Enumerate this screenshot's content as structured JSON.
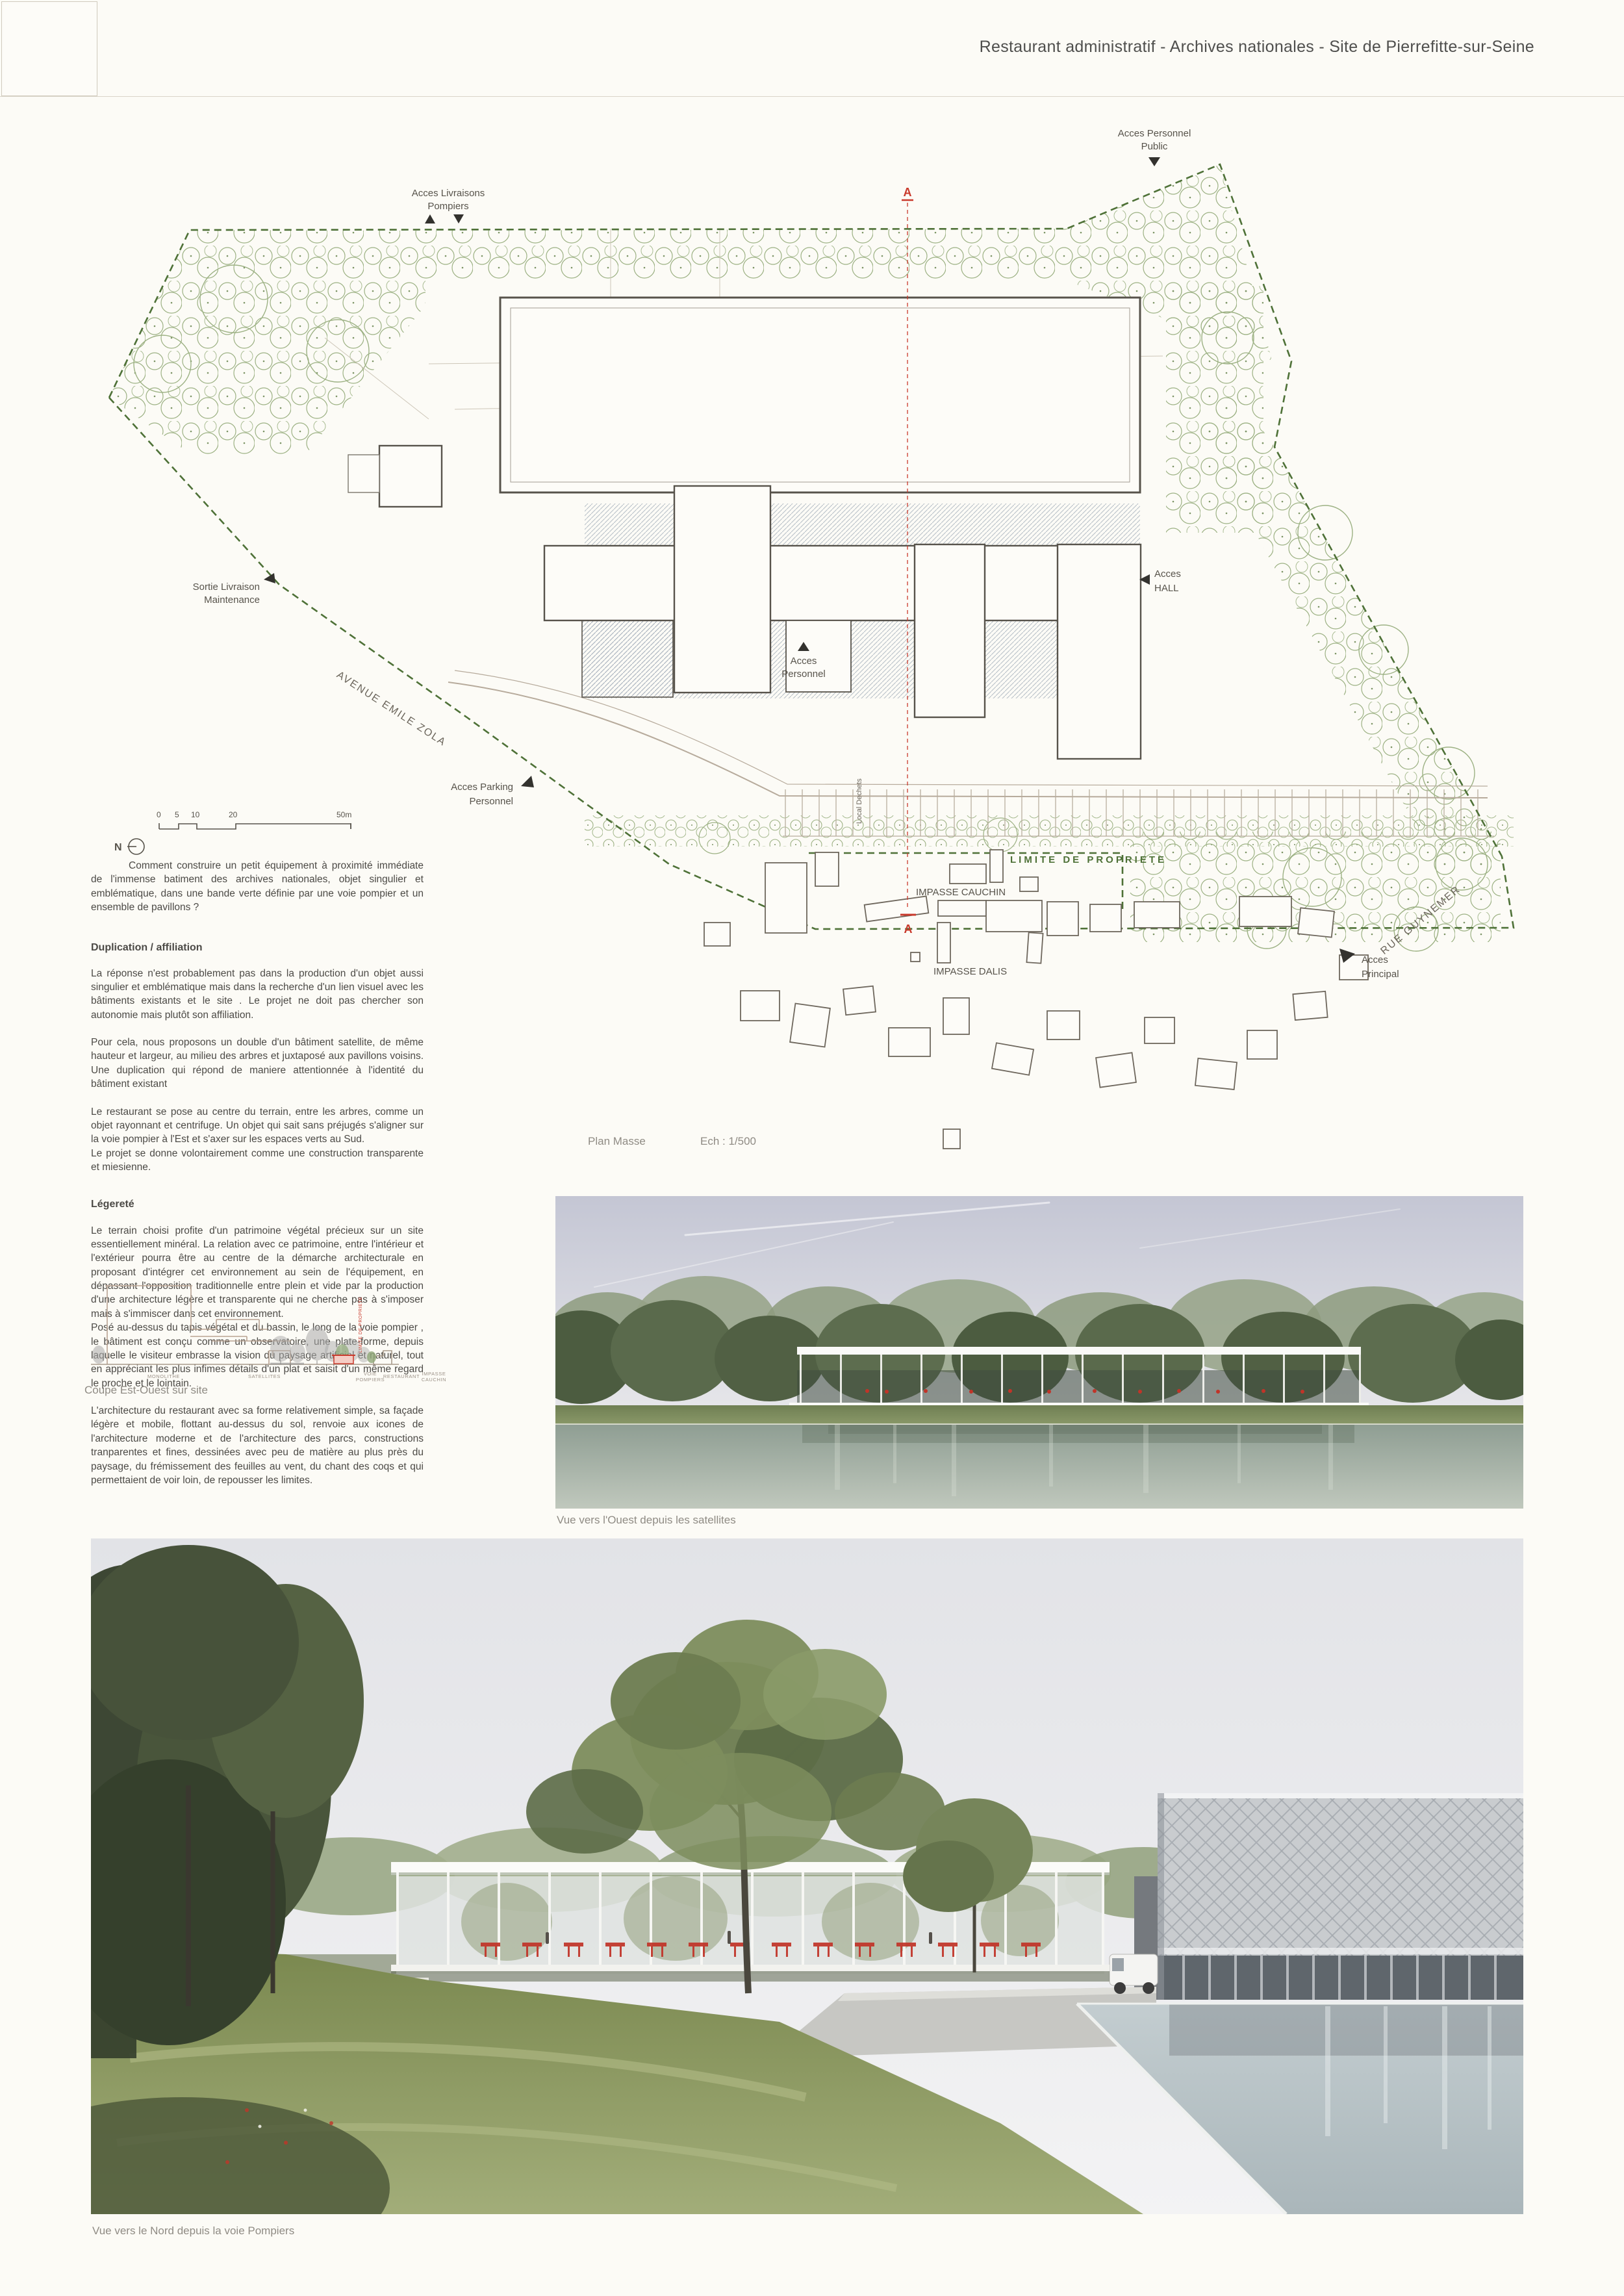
{
  "header": {
    "title": "Restaurant administratif - Archives nationales - Site de Pierrefitte-sur-Seine"
  },
  "plan": {
    "caption_name": "Plan Masse",
    "caption_scale": "Ech : 1/500",
    "north_label": "N",
    "scale_ticks": [
      "0",
      "5",
      "10",
      "20",
      "50m"
    ],
    "section_marker": "A",
    "labels": {
      "livraisons_1": "Acces Livraisons",
      "livraisons_2": "Pompiers",
      "personnel_public_1": "Acces Personnel",
      "personnel_public_2": "Public",
      "sortie_1": "Sortie Livraison",
      "sortie_2": "Maintenance",
      "hall_1": "Acces",
      "hall_2": "HALL",
      "personnel_1": "Acces",
      "personnel_2": "Personnel",
      "parking_1": "Acces Parking",
      "parking_2": "Personnel",
      "principal_1": "Acces",
      "principal_2": "Principal",
      "avenue_emile_zola": "AVENUE EMILE ZOLA",
      "rue_guynemer": "RUE GUYNEMER",
      "limite_de_propriete": "LIMITE DE PROPRIETE",
      "impasse_cauchin": "IMPASSE CAUCHIN",
      "impasse_dalis": "IMPASSE DALIS",
      "local_dechets": "Local Dechets"
    }
  },
  "essay": {
    "intro": "Comment construire un petit équipement à proximité immédiate de l'immense batiment des archives nationales, objet singulier et emblématique, dans une bande verte définie par une voie pompier et un ensemble de pavillons ?",
    "sections": [
      {
        "heading": "Duplication / affiliation",
        "paragraphs": [
          "La réponse n'est probablement pas dans la production d'un objet aussi singulier et emblématique mais dans la recherche d'un lien visuel avec les bâtiments existants et le site . Le projet ne doit pas chercher son autonomie mais plutôt son affiliation.",
          "Pour cela, nous proposons un double d'un bâtiment satellite, de même hauteur et largeur, au milieu des arbres et juxtaposé aux pavillons voisins. Une duplication qui répond de maniere attentionnée à l'identité du bâtiment existant",
          "Le restaurant se pose au centre du terrain, entre les arbres, comme un objet rayonnant et centrifuge. Un objet qui sait sans préjugés s'aligner sur la voie pompier à l'Est et s'axer sur les espaces verts au Sud.\nLe projet se donne volontairement comme une construction transparente et miesienne."
        ]
      },
      {
        "heading": "Légereté",
        "paragraphs": [
          "Le terrain choisi profite d'un patrimoine végétal précieux sur un site essentiellement minéral. La relation avec ce patrimoine, entre l'intérieur et l'extérieur pourra être au centre de la démarche architecturale en proposant d'intégrer cet environnement au sein de l'équipement, en dépassant l'opposition traditionnelle entre plein et vide par la production d'une architecture légère et transparente qui ne cherche pas à s'imposer mais à s'immiscer dans cet environnement.\nPosé au-dessus du tapis végétal et du bassin, le long de la voie pompier , le bâtiment est conçu comme un observatoire, une plate-forme, depuis laquelle le visiteur embrasse la vision du paysage artificiel et naturel, tout en appréciant les plus infimes détails d'un plat et saisit d'un même regard le proche et le lointain.",
          "L'architecture du restaurant avec sa forme relativement simple, sa façade légère et mobile, flottant au-dessus du sol, renvoie aux icones de l'architecture moderne et de l'architecture des parcs, constructions tranparentes et fines, dessinées avec peu de matière au plus près du paysage, du frémissement des feuilles au vent, du chant des coqs et qui permettaient de voir loin, de repousser les limites."
        ]
      }
    ]
  },
  "coupe": {
    "caption": "Coupe Est-Ouest sur site",
    "limite_vertical": "LIMITE DE PROPRIETE",
    "labels": [
      {
        "l1": "MONOLITHE",
        "l2": ""
      },
      {
        "l1": "SATELLITES",
        "l2": ""
      },
      {
        "l1": "VOIE",
        "l2": "POMPIERS"
      },
      {
        "l1": "RESTAURANT",
        "l2": ""
      },
      {
        "l1": "IMPASSE",
        "l2": "CAUCHIN"
      }
    ]
  },
  "renders": [
    {
      "caption": "Vue vers l'Ouest depuis les satellites"
    },
    {
      "caption": "Vue vers le Nord depuis la voie Pompiers"
    }
  ],
  "colors": {
    "accent_red": "#c9392b",
    "tree_green": "#9cb183",
    "boundary_green": "#4e7137"
  }
}
